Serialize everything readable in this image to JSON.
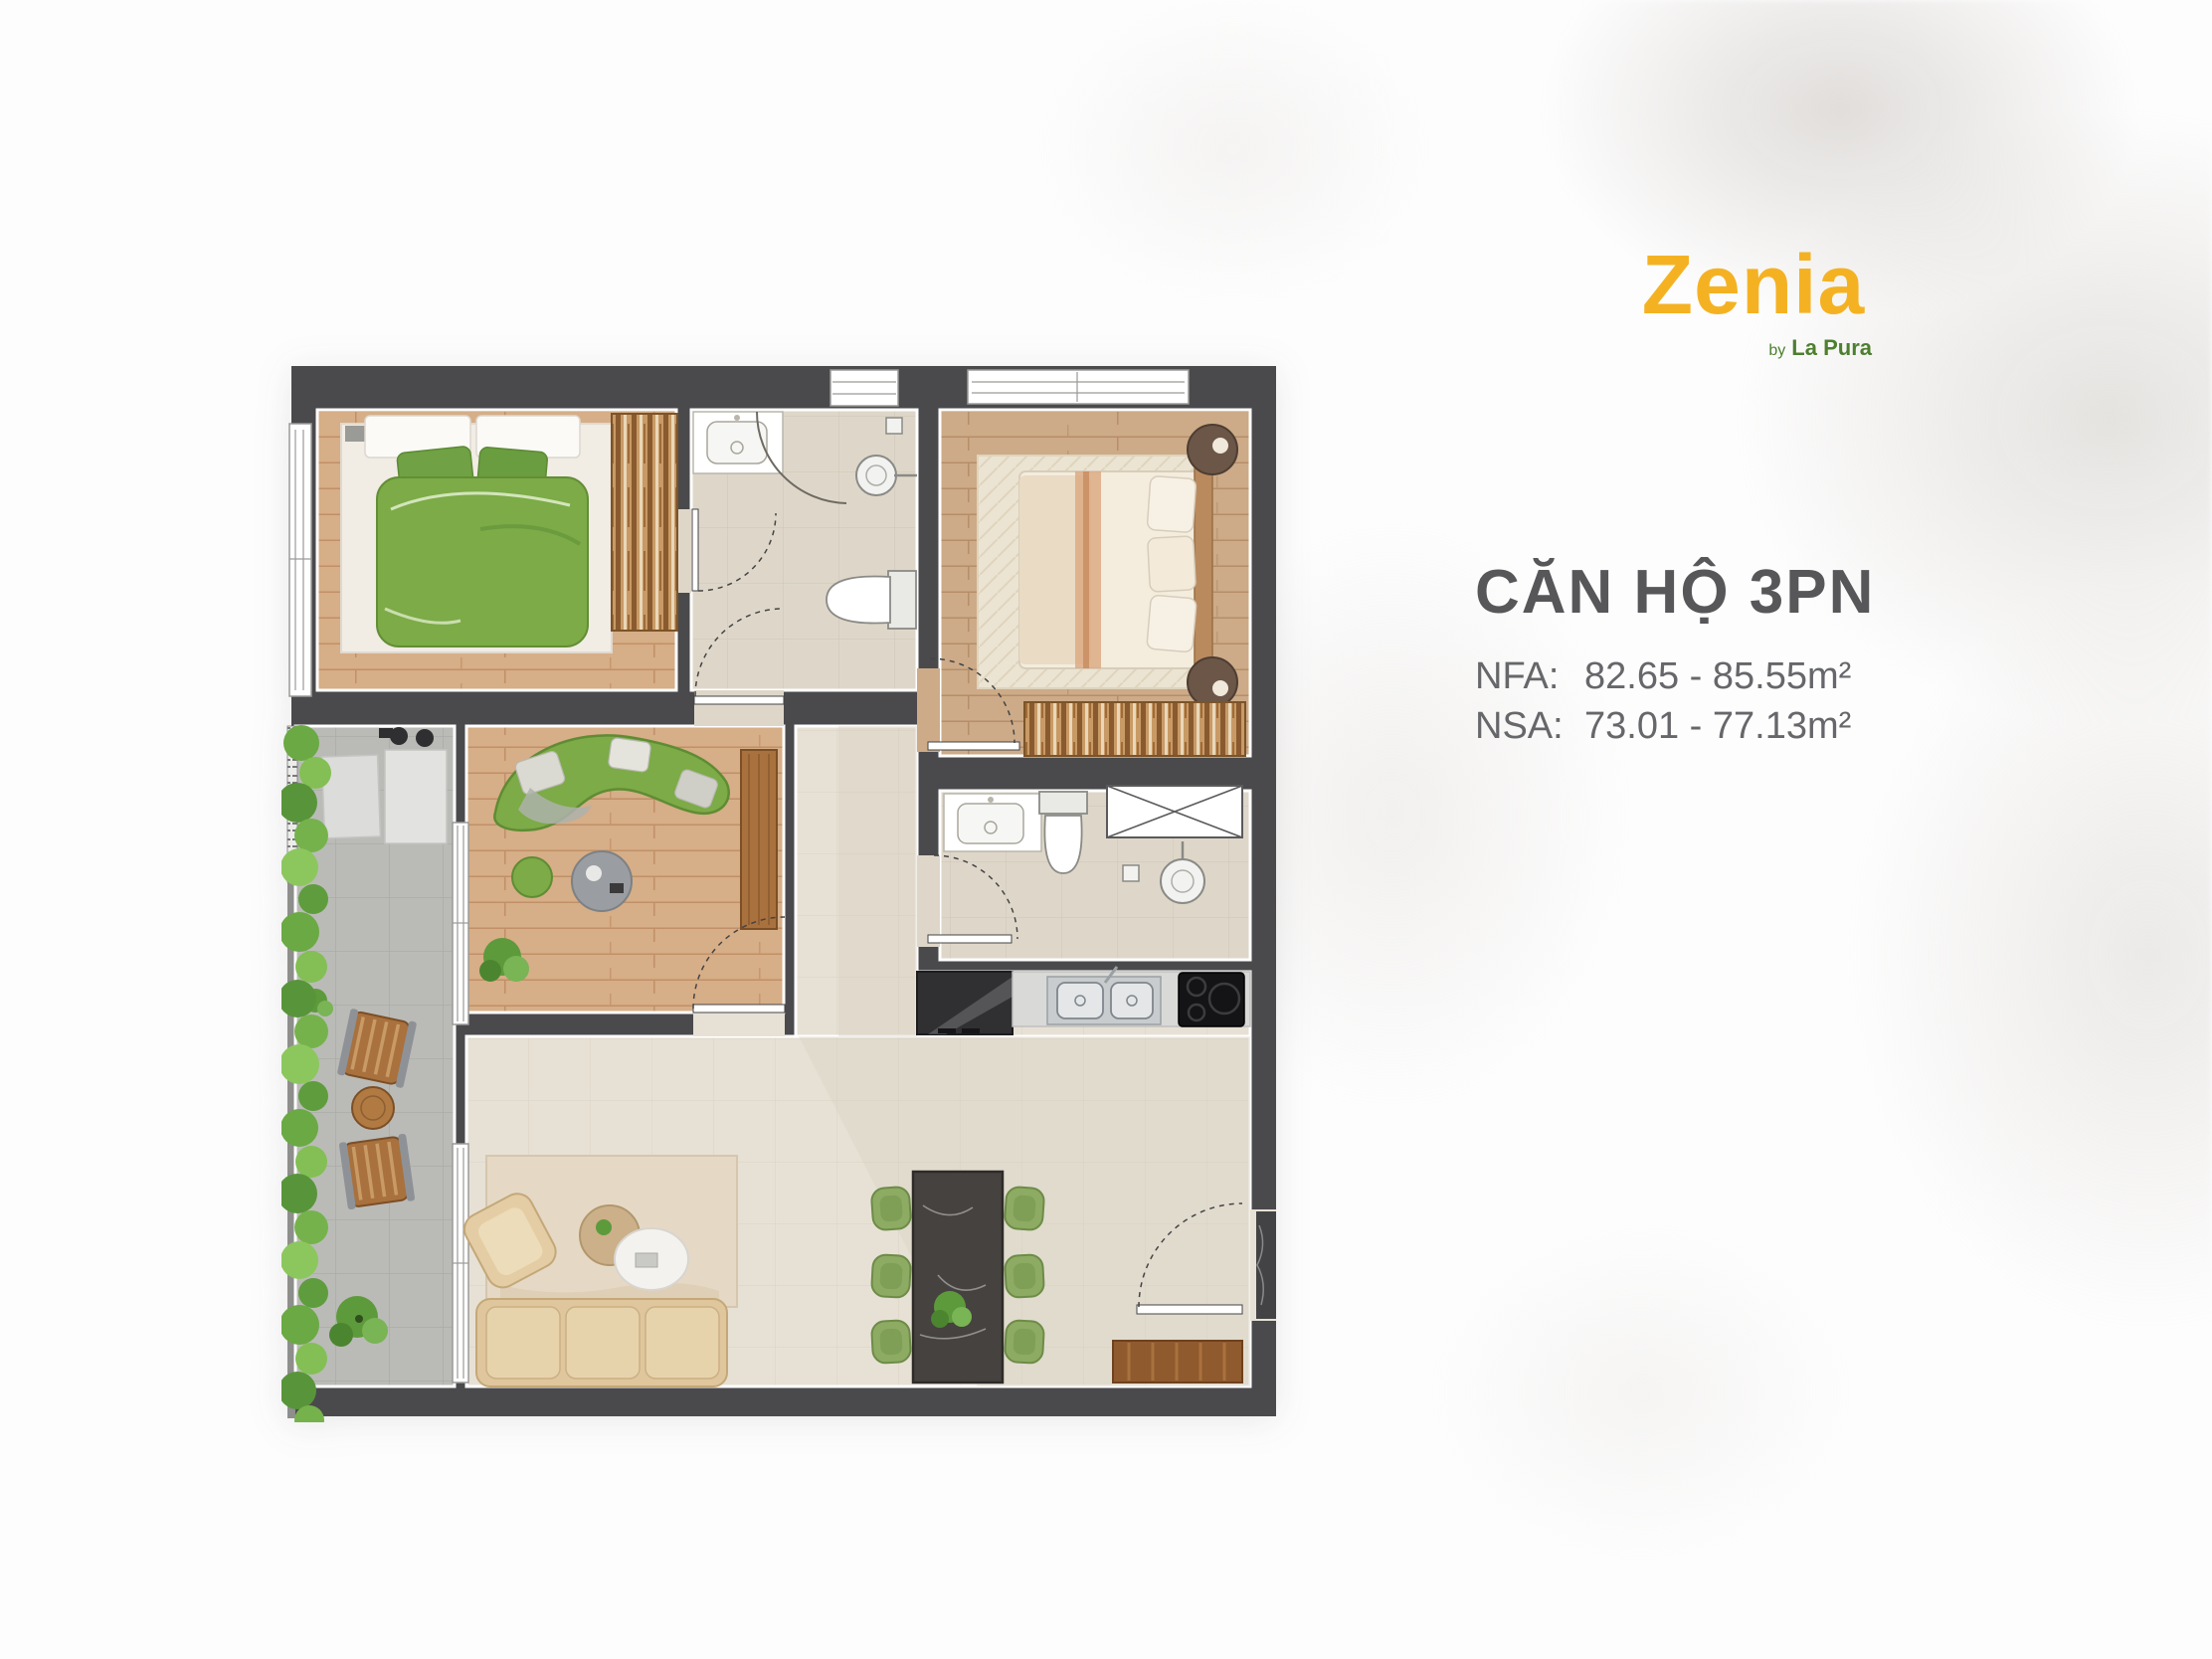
{
  "brand": {
    "logo": "Zenia",
    "by": "by",
    "name": "La Pura"
  },
  "unit_info": {
    "title": "CĂN HỘ 3PN",
    "rows": [
      {
        "label": "NFA:",
        "value": "82.65 - 85.55m²"
      },
      {
        "label": "NSA:",
        "value": "73.01 - 77.13m²"
      }
    ]
  },
  "palette": {
    "logo_yellow": "#F4B223",
    "logo_green": "#4D7F2F",
    "title_gray": "#57575A",
    "text_gray": "#66676A",
    "wall": "#4A4A4C",
    "wood_floor": "#D6AE87",
    "wood_floor_master": "#CDAB88",
    "tile_beige": "#E7E1D5",
    "tile_bath": "#DED7C9",
    "tile_gray_balcony": "#BABBB7",
    "furniture_green": "#7CAB47",
    "sofa_beige": "#DFC69C",
    "dining_marble": "#46423F",
    "hedge_green": "#6AA944"
  },
  "floor_plan": {
    "elements": [
      "bedroom-green-double-bed",
      "bedroom-wardrobe",
      "bathroom-sink",
      "shower-head",
      "toilet",
      "master-double-bed",
      "nightstand",
      "area-rug",
      "curved-green-sofa",
      "green-pouf",
      "round-coffee-table",
      "potted-plant",
      "wood-cabinet",
      "balcony-hedge",
      "outdoor-wood-chair",
      "outdoor-round-table",
      "washing-machine",
      "kitchen-double-sink",
      "cooktop",
      "refrigerator",
      "dining-table",
      "dining-chair",
      "living-sofa",
      "armchair",
      "side-tables",
      "entry-door",
      "interior-door",
      "window"
    ]
  }
}
